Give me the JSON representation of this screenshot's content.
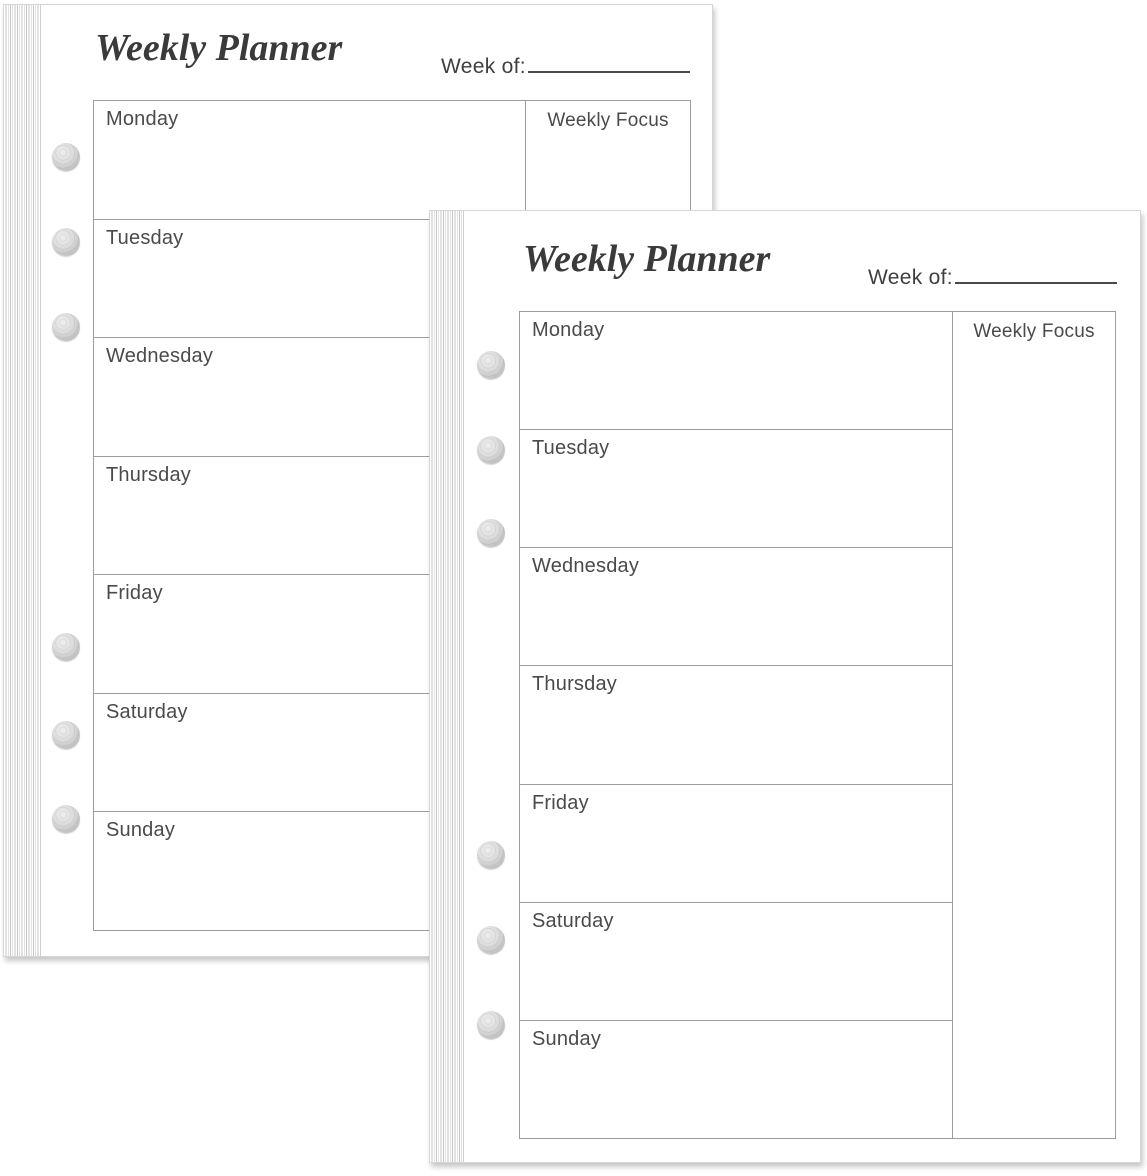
{
  "planner": {
    "title": "Weekly Planner",
    "week_of_label": "Week of:",
    "weekly_focus_label": "Weekly Focus",
    "days": [
      "Monday",
      "Tuesday",
      "Wednesday",
      "Thursday",
      "Friday",
      "Saturday",
      "Sunday"
    ]
  },
  "colors": {
    "page_background": "#ffffff",
    "table_border": "#9c9c9c",
    "title_text": "#3a3a3a",
    "label_text": "#4a4a4a",
    "stack_edge_stripe": "#c6c6c6",
    "hole_gray": "#bdbdbd"
  }
}
